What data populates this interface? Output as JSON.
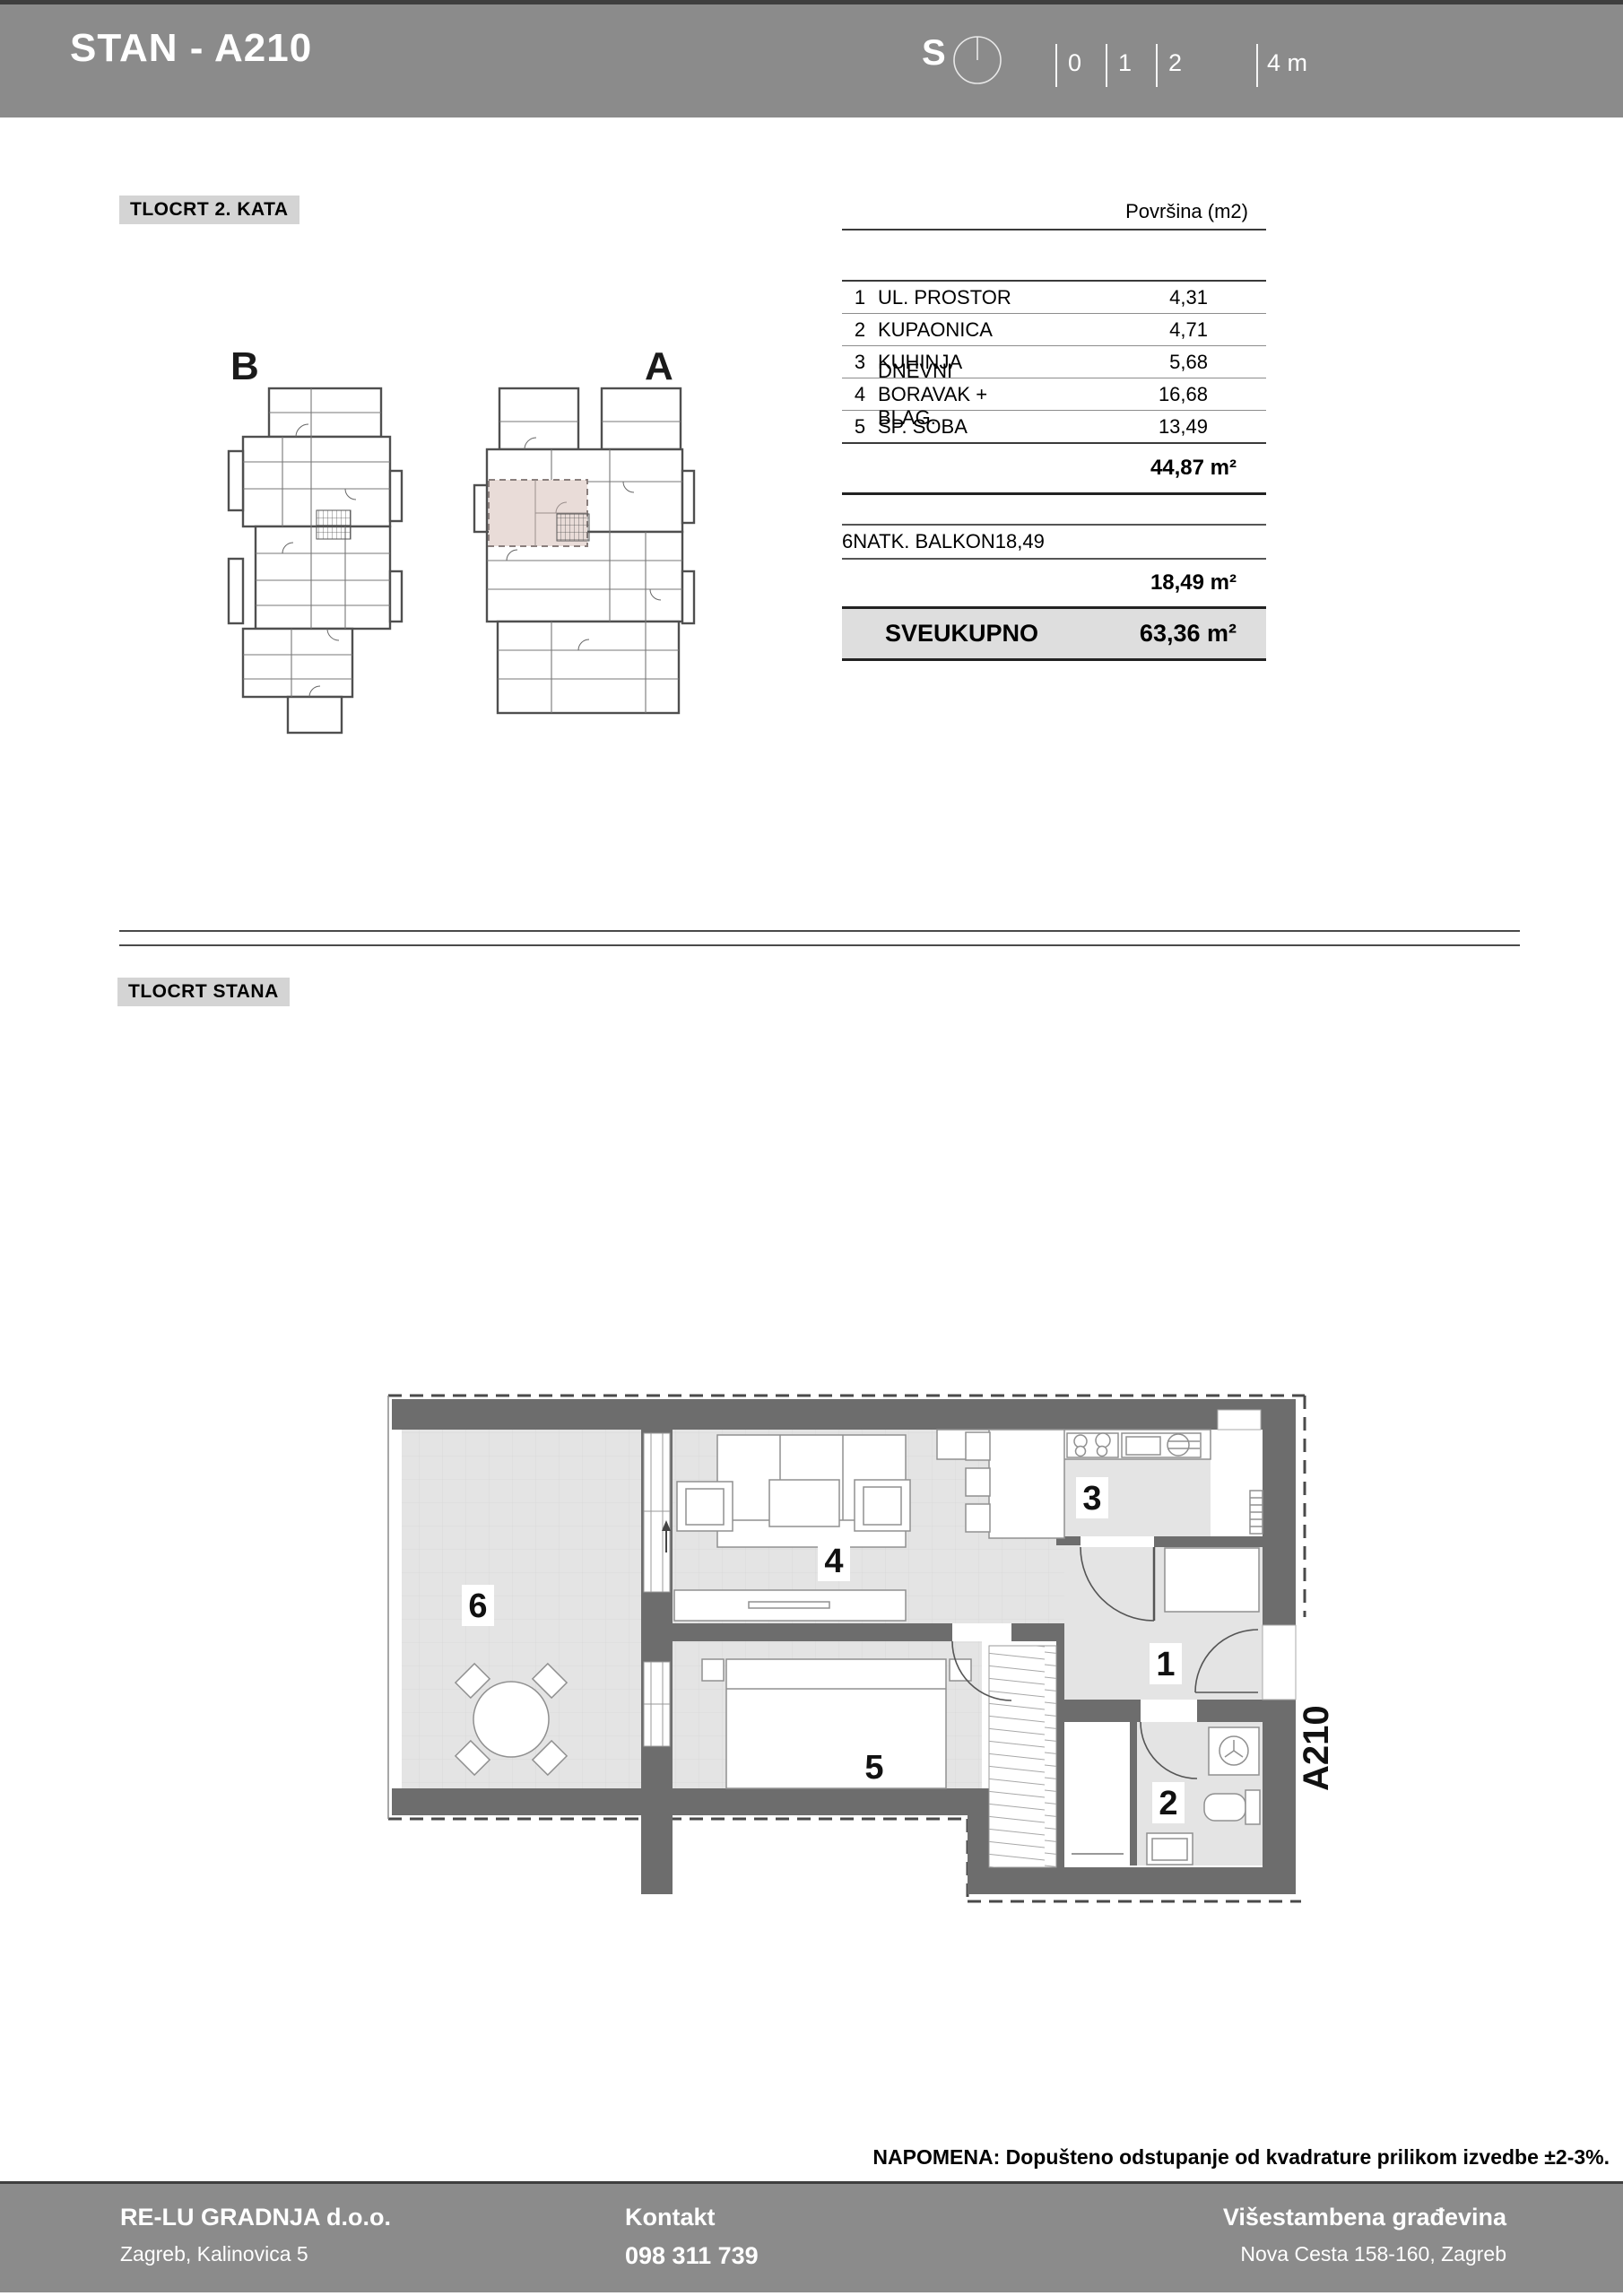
{
  "header": {
    "title": "STAN - A210",
    "north_label": "S",
    "scale_ticks": [
      "0",
      "1",
      "2"
    ],
    "scale_end": "4 m"
  },
  "sections": {
    "floor_label": "TLOCRT 2. KATA",
    "unit_label": "TLOCRT STANA"
  },
  "mini_plans": {
    "left": "B",
    "right": "A"
  },
  "area_table": {
    "header": "Površina (m2)",
    "rows": [
      {
        "num": "1",
        "name": "UL. PROSTOR",
        "area": "4,31"
      },
      {
        "num": "2",
        "name": "KUPAONICA",
        "area": "4,71"
      },
      {
        "num": "3",
        "name": "KUHINJA",
        "area": "5,68"
      },
      {
        "num": "4",
        "name": "DNEVNI BORAVAK + BLAG.",
        "area": "16,68"
      },
      {
        "num": "5",
        "name": "SP. SOBA",
        "area": "13,49"
      }
    ],
    "subtotal": "44,87 m²",
    "balcony_row": {
      "num": "6",
      "name": "NATK. BALKON",
      "area": "18,49"
    },
    "balcony_subtotal": "18,49 m²",
    "total_label": "SVEUKUPNO",
    "total_value": "63,36 m²"
  },
  "floor_plan": {
    "r1": "1",
    "r2": "2",
    "r3": "3",
    "r4": "4",
    "r5": "5",
    "r6": "6",
    "unit": "A210"
  },
  "note": "NAPOMENA: Dopušteno odstupanje od kvadrature prilikom izvedbe ±2-3%.",
  "footer": {
    "company": "RE-LU GRADNJA d.o.o.",
    "company_address": "Zagreb, Kalinovica 5",
    "contact_label": "Kontakt",
    "contact_phone": "098 311 739",
    "building": "Višestambena građevina",
    "building_address": "Nova Cesta 158-160, Zagreb"
  },
  "colors": {
    "bar_gray": "#8b8b8b",
    "wall_gray": "#6d6d6d",
    "floor_gray": "#e4e4e4",
    "highlight_pink": "#e9dcd8",
    "chip_gray": "#d4d4d4"
  }
}
